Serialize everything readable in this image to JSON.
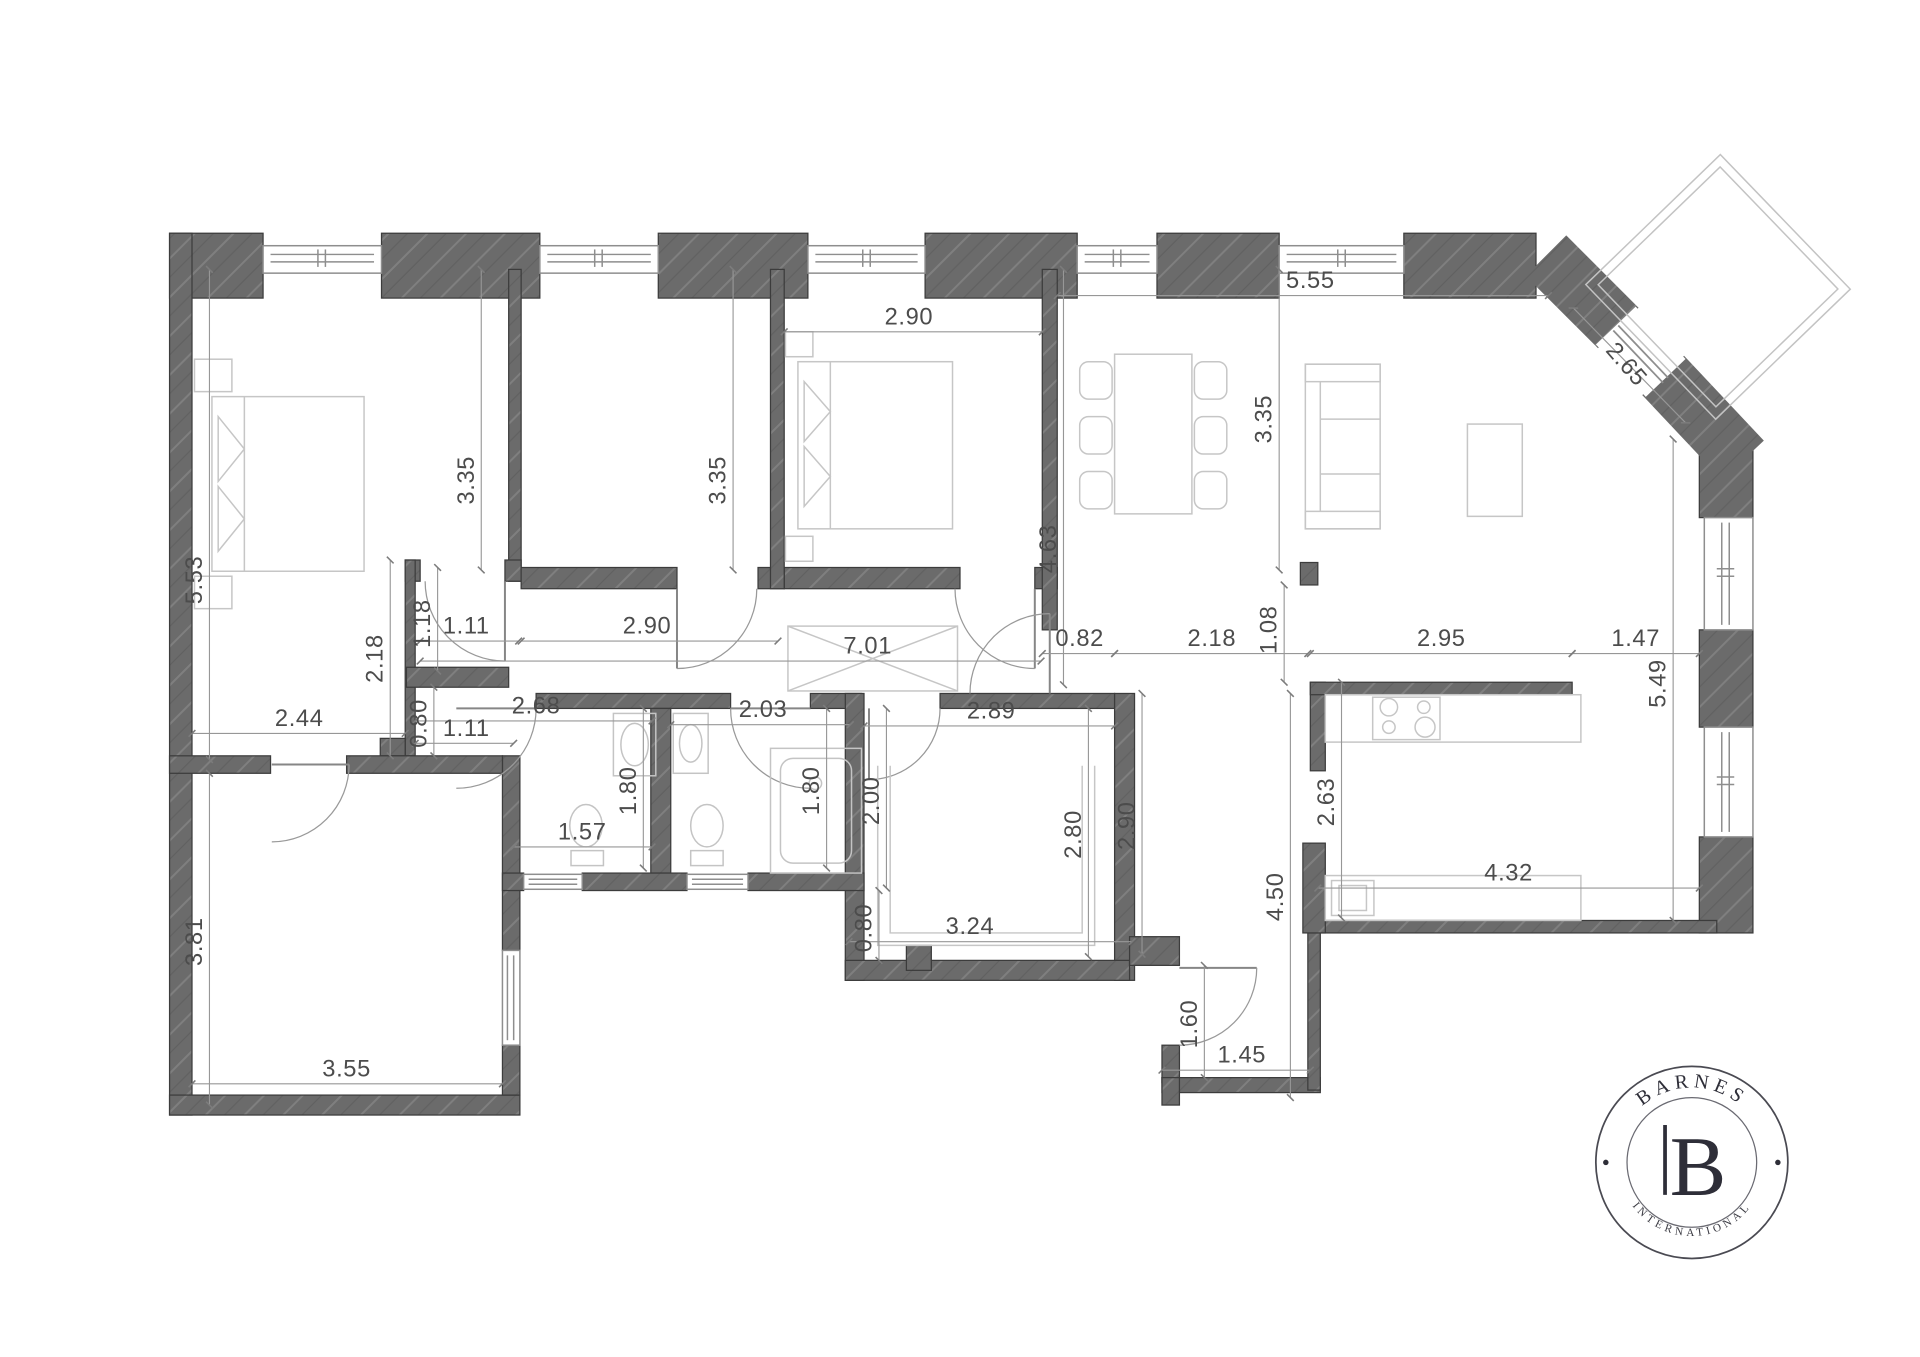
{
  "logo": {
    "brand": "BARNES",
    "monogram": "B",
    "subtitle": "INTERNATIONAL"
  },
  "dims": [
    {
      "v": "2.90",
      "x": 729,
      "y": 260,
      "r": 0
    },
    {
      "v": "5.55",
      "x": 1051,
      "y": 231,
      "r": 0
    },
    {
      "v": "2.65",
      "x": 1300,
      "y": 296,
      "r": 49
    },
    {
      "v": "3.35",
      "x": 380,
      "y": 385,
      "r": -90
    },
    {
      "v": "3.35",
      "x": 582,
      "y": 385,
      "r": -90
    },
    {
      "v": "4.63",
      "x": 847,
      "y": 440,
      "r": -90
    },
    {
      "v": "3.35",
      "x": 1020,
      "y": 336,
      "r": -90
    },
    {
      "v": "5.53",
      "x": 162,
      "y": 465,
      "r": -90
    },
    {
      "v": "1.11",
      "x": 374,
      "y": 508,
      "r": 0
    },
    {
      "v": "2.90",
      "x": 519,
      "y": 508,
      "r": 0
    },
    {
      "v": "1.18",
      "x": 345,
      "y": 500,
      "r": -90
    },
    {
      "v": "2.18",
      "x": 307,
      "y": 528,
      "r": -90
    },
    {
      "v": "7.01",
      "x": 696,
      "y": 524,
      "r": 0
    },
    {
      "v": "0.82",
      "x": 866,
      "y": 518,
      "r": 0
    },
    {
      "v": "2.18",
      "x": 972,
      "y": 518,
      "r": 0
    },
    {
      "v": "1.08",
      "x": 1024,
      "y": 505,
      "r": -90
    },
    {
      "v": "2.95",
      "x": 1156,
      "y": 518,
      "r": 0
    },
    {
      "v": "1.47",
      "x": 1312,
      "y": 518,
      "r": 0
    },
    {
      "v": "5.49",
      "x": 1336,
      "y": 548,
      "r": -90
    },
    {
      "v": "2.44",
      "x": 240,
      "y": 582,
      "r": 0
    },
    {
      "v": "0.80",
      "x": 342,
      "y": 580,
      "r": -90
    },
    {
      "v": "1.11",
      "x": 374,
      "y": 590,
      "r": 0
    },
    {
      "v": "2.68",
      "x": 430,
      "y": 572,
      "r": 0
    },
    {
      "v": "2.03",
      "x": 612,
      "y": 575,
      "r": 0
    },
    {
      "v": "2.89",
      "x": 795,
      "y": 576,
      "r": 0
    },
    {
      "v": "1.80",
      "x": 510,
      "y": 634,
      "r": -90
    },
    {
      "v": "1.80",
      "x": 657,
      "y": 634,
      "r": -90
    },
    {
      "v": "2.00",
      "x": 705,
      "y": 642,
      "r": -90
    },
    {
      "v": "2.63",
      "x": 1070,
      "y": 643,
      "r": -90
    },
    {
      "v": "1.57",
      "x": 467,
      "y": 673,
      "r": 0
    },
    {
      "v": "2.80",
      "x": 867,
      "y": 669,
      "r": -90
    },
    {
      "v": "2.90",
      "x": 910,
      "y": 662,
      "r": -90
    },
    {
      "v": "0.80",
      "x": 699,
      "y": 744,
      "r": -90
    },
    {
      "v": "3.24",
      "x": 778,
      "y": 749,
      "r": 0
    },
    {
      "v": "4.50",
      "x": 1029,
      "y": 719,
      "r": -90
    },
    {
      "v": "4.32",
      "x": 1210,
      "y": 706,
      "r": 0
    },
    {
      "v": "3.81",
      "x": 162,
      "y": 755,
      "r": -90
    },
    {
      "v": "1.60",
      "x": 960,
      "y": 821,
      "r": -90
    },
    {
      "v": "1.45",
      "x": 996,
      "y": 852,
      "r": 0
    },
    {
      "v": "3.55",
      "x": 278,
      "y": 863,
      "r": 0
    }
  ]
}
